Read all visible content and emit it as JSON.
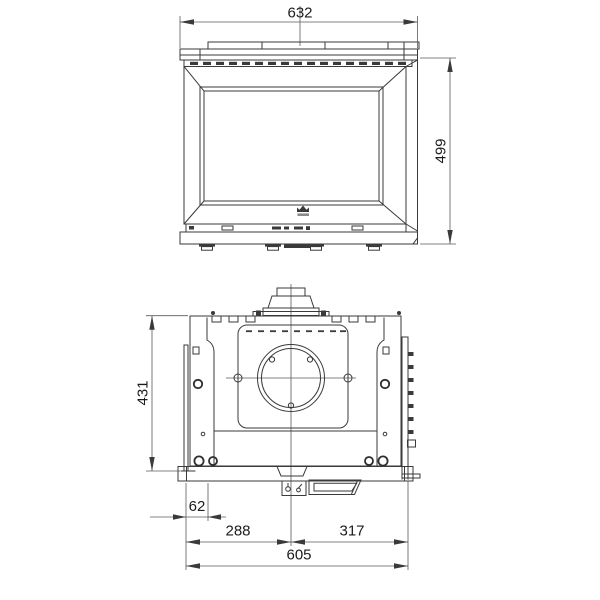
{
  "drawing": {
    "kind": "technical-dimension-drawing",
    "background": "#ffffff",
    "line_color": "#3a3a3a",
    "text_color": "#1c1c1c",
    "views": {
      "front": {
        "name": "front-elevation-view"
      },
      "top": {
        "name": "top-plan-view"
      }
    },
    "icons": {
      "brand_emblem": "brand-emblem-icon"
    },
    "dimensions": {
      "front_width_mm": "632",
      "front_height_mm": "499",
      "depth_mm": "431",
      "side_offset_mm": "62",
      "flue_center_from_left_mm": "288",
      "flue_center_to_right_mm": "317",
      "overall_width_mm": "605"
    }
  }
}
